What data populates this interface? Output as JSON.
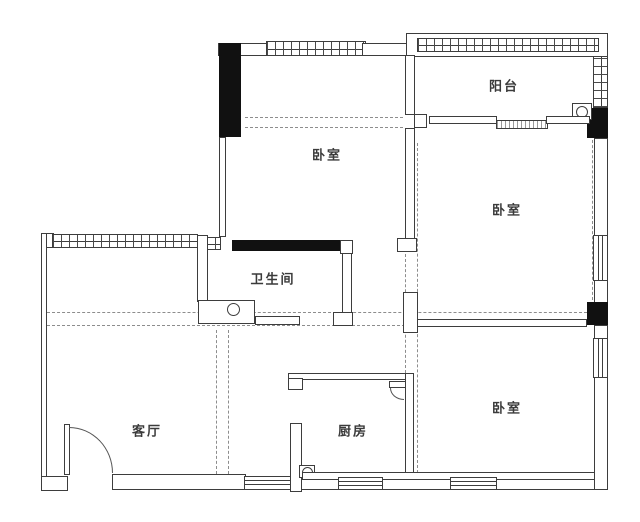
{
  "page": {
    "type": "apartment-floor-plan"
  },
  "rooms": {
    "balcony": {
      "label": "阳台"
    },
    "bedroom_north": {
      "label": "卧室"
    },
    "bedroom_east": {
      "label": "卧室"
    },
    "bedroom_southeast": {
      "label": "卧室"
    },
    "bathroom": {
      "label": "卫生间"
    },
    "living_room": {
      "label": "客厅"
    },
    "kitchen": {
      "label": "厨房"
    }
  },
  "colors": {
    "background": "#ffffff",
    "wall_line": "#3d3d3d",
    "solid_fill": "#111111",
    "dashed_line": "#8d8d8d",
    "label_text": "#3b3b3b"
  },
  "fixtures": [
    "entry-door",
    "kitchen-door",
    "balcony-sliding-door",
    "bathroom-sink",
    "bathroom-counter",
    "bathroom-shelf",
    "washing-machine",
    "gas-meter"
  ]
}
